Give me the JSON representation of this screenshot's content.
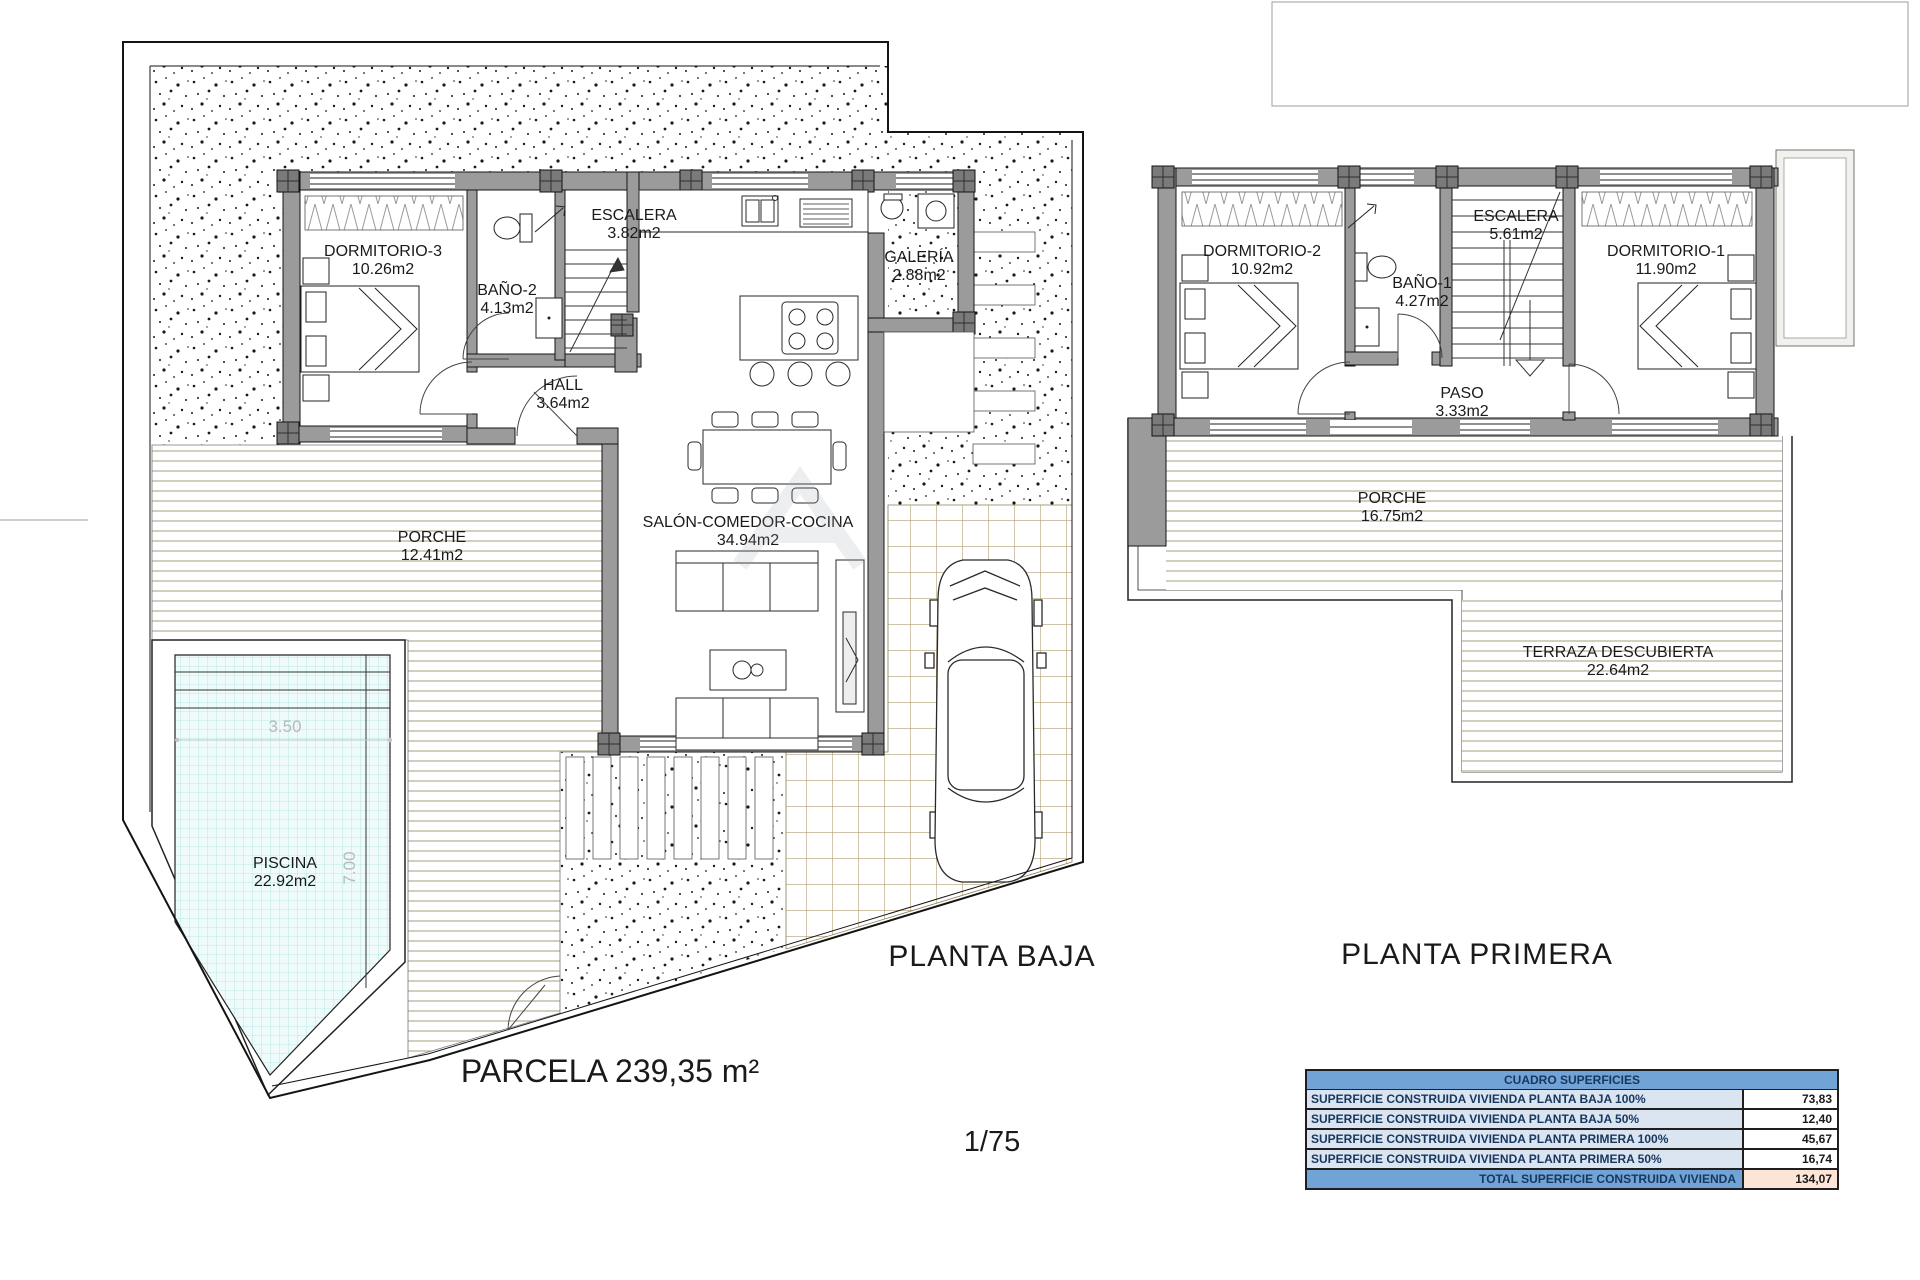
{
  "ground_floor": {
    "title": "PLANTA BAJA",
    "rooms": {
      "dormitorio3": {
        "name": "DORMITORIO-3",
        "area": "10.26m2"
      },
      "bano2": {
        "name": "BAÑO-2",
        "area": "4.13m2"
      },
      "escalera": {
        "name": "ESCALERA",
        "area": "3.82m2"
      },
      "galeria": {
        "name": "GALERÍA",
        "area": "2.88m2"
      },
      "hall": {
        "name": "HALL",
        "area": "3.64m2"
      },
      "salon": {
        "name": "SALÓN-COMEDOR-COCINA",
        "area": "34.94m2"
      },
      "porche": {
        "name": "PORCHE",
        "area": "12.41m2"
      },
      "piscina": {
        "name": "PISCINA",
        "area": "22.92m2"
      }
    },
    "pool_dimensions": {
      "width": "3.50",
      "length": "7.00"
    },
    "parcel_label": "PARCELA 239,35 m²",
    "scale": "1/75"
  },
  "first_floor": {
    "title": "PLANTA PRIMERA",
    "rooms": {
      "dormitorio2": {
        "name": "DORMITORIO-2",
        "area": "10.92m2"
      },
      "bano1": {
        "name": "BAÑO-1",
        "area": "4.27m2"
      },
      "escalera": {
        "name": "ESCALERA",
        "area": "5.61m2"
      },
      "paso": {
        "name": "PASO",
        "area": "3.33m2"
      },
      "dormitorio1": {
        "name": "DORMITORIO-1",
        "area": "11.90m2"
      },
      "porche": {
        "name": "PORCHE",
        "area": "16.75m2"
      },
      "terraza": {
        "name": "TERRAZA DESCUBIERTA",
        "area": "22.64m2"
      }
    }
  },
  "surface_table": {
    "title": "CUADRO SUPERFICIES",
    "rows": [
      {
        "label": "SUPERFICIE CONSTRUIDA VIVIENDA PLANTA BAJA 100%",
        "value": "73,83"
      },
      {
        "label": "SUPERFICIE CONSTRUIDA VIVIENDA PLANTA BAJA 50%",
        "value": "12,40"
      },
      {
        "label": "SUPERFICIE CONSTRUIDA VIVIENDA PLANTA PRIMERA 100%",
        "value": "45,67"
      },
      {
        "label": "SUPERFICIE CONSTRUIDA VIVIENDA PLANTA PRIMERA 50%",
        "value": "16,74"
      }
    ],
    "total": {
      "label": "TOTAL SUPERFICIE CONSTRUIDA VIVIENDA",
      "value": "134,07"
    }
  },
  "colors": {
    "wall_gray": "#9b9b9b",
    "table_header_blue": "#71a3d7",
    "table_row_blue": "#dbe5f1",
    "table_total_peach": "#fce4d6",
    "pool_water": "#effbfb",
    "deck_line_tan": "#b7ae94"
  }
}
